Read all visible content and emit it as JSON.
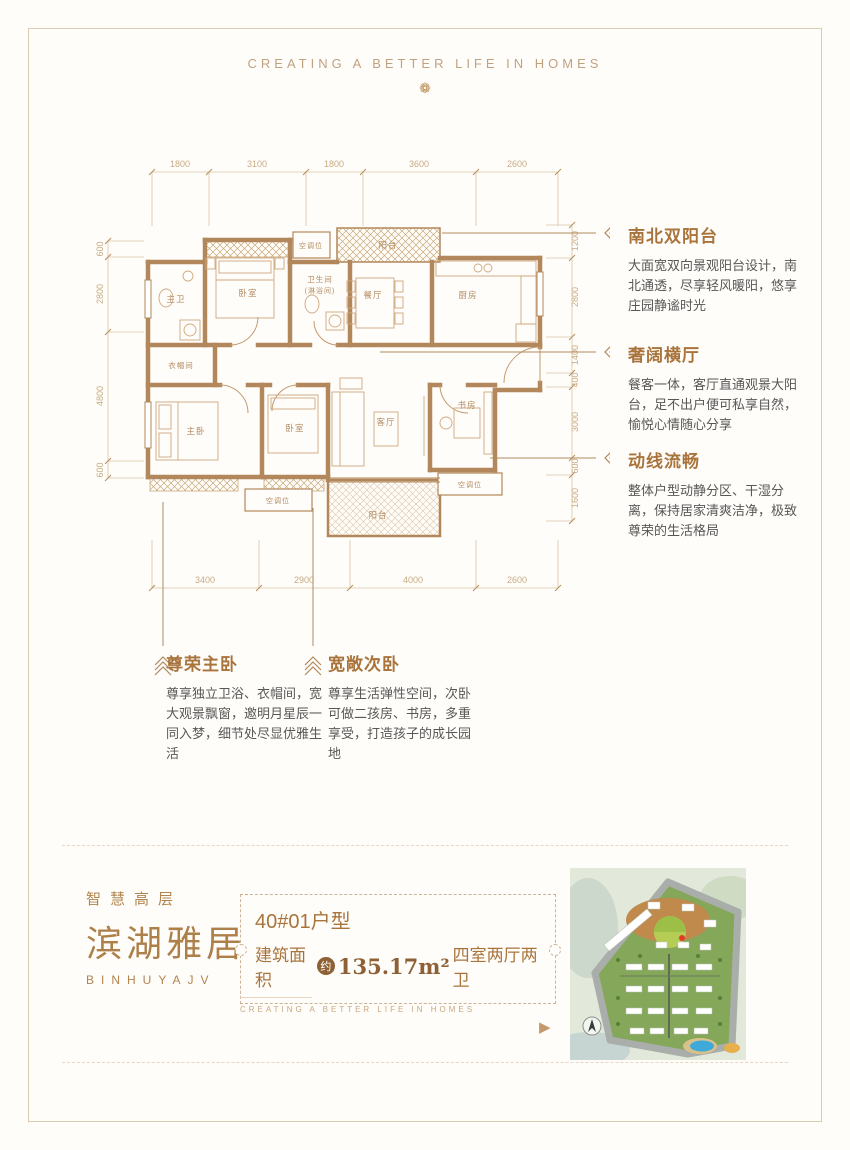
{
  "page": {
    "header_motto": "CREATING A BETTER LIFE IN HOMES",
    "footer_motto": "CREATING A BETTER LIFE IN HOMES",
    "ornament": "❁"
  },
  "colors": {
    "accent": "#a9743c",
    "wall": "#b2875b",
    "dim": "#cdb28c",
    "body_text": "#595756"
  },
  "floorplan": {
    "dims_top": [
      "1800",
      "3100",
      "1800",
      "3600",
      "2600"
    ],
    "dims_bottom": [
      "3400",
      "2900",
      "4000",
      "2600"
    ],
    "dims_left": [
      "600",
      "2800",
      "4800",
      "600"
    ],
    "dims_right": [
      "1200",
      "2800",
      "1400",
      "400",
      "3000",
      "600",
      "1600"
    ],
    "rooms": {
      "master_bath": "主卫",
      "bedroom_top": "卧室",
      "bathroom": "卫生间",
      "bathroom_note": "(淋浴间)",
      "ac_top": "空调位",
      "balcony_north": "阳台",
      "dining": "餐厅",
      "kitchen": "厨房",
      "cloakroom": "衣帽间",
      "master_bedroom": "主卧",
      "bedroom_bottom": "卧室",
      "living": "客厅",
      "study": "书房",
      "ac_bottom_left": "空调位",
      "ac_bottom_right": "空调位",
      "balcony_south": "阳台"
    }
  },
  "annotations": [
    {
      "title": "南北双阳台",
      "body": "大面宽双向景观阳台设计，南北通透，尽享轻风暖阳，悠享庄园静谧时光"
    },
    {
      "title": "奢阔横厅",
      "body": "餐客一体，客厅直通观景大阳台，足不出户便可私享自然，愉悦心情随心分享"
    },
    {
      "title": "动线流畅",
      "body": "整体户型动静分区、干湿分离，保持居家清爽洁净，极致尊荣的生活格局"
    },
    {
      "title": "尊荣主卧",
      "body": "尊享独立卫浴、衣帽间，宽大观景飘窗，邀明月星辰一同入梦，细节处尽显优雅生活"
    },
    {
      "title": "宽敞次卧",
      "body": "尊享生活弹性空间，次卧可做二孩房、书房，多重享受，打造孩子的成长园地"
    }
  ],
  "brand": {
    "tagline": "智慧高层",
    "name": "滨湖雅居",
    "name_en": "BINHUYAJV"
  },
  "unit": {
    "title": "40#01户型",
    "area_prefix": "建筑面积",
    "approx_badge": "约",
    "area_value": "135.17m²",
    "layout": "四室两厅两卫"
  }
}
